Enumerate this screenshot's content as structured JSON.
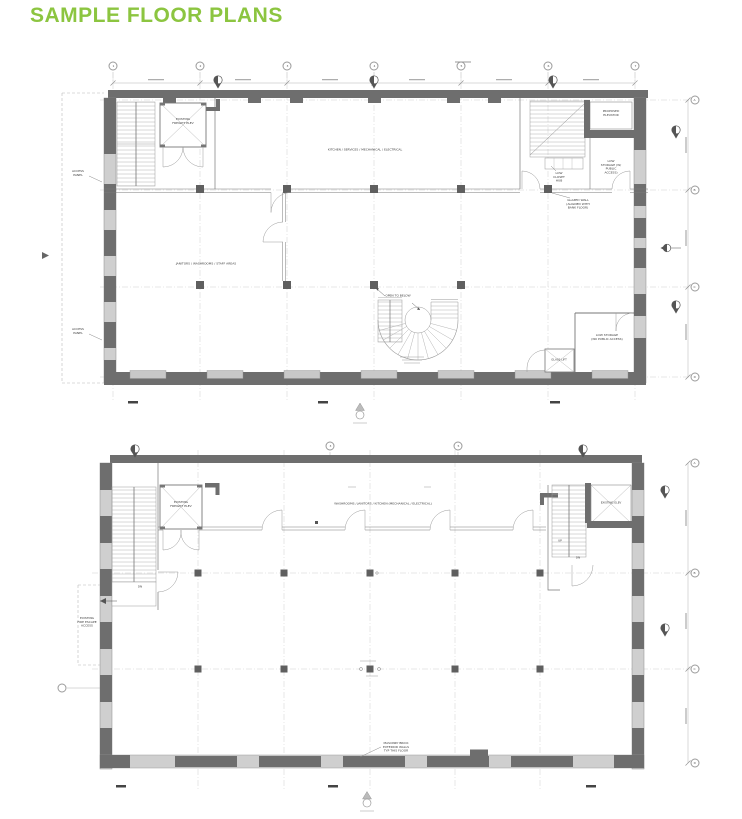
{
  "page": {
    "title": "SAMPLE FLOOR PLANS",
    "accent_green": "#8cc540",
    "wall_dark": "#6e6e6e",
    "wall_light": "#cfcfcf"
  },
  "plan_upper": {
    "grid_top": [
      "1",
      "2",
      "3",
      "4",
      "5",
      "6",
      "7"
    ],
    "grid_right": [
      "A",
      "B",
      "C",
      "D"
    ],
    "labels": {
      "freight_elev": "EXISTING\nFREIGHT ELEV",
      "kitchen": "KITCHEN / SERVICES / MECHANICAL / ELECTRICAL",
      "janitors": "JANITORS / WASHROOMS / STAFF AREAS",
      "open_to_below": "OPEN TO BELOW",
      "access_panel_1": "ACCESS\nPANEL",
      "access_panel_2": "ACCESS\nPANEL",
      "proposed_elev": "PROPOSED\nELEVATOR",
      "low_closet": "LOW\nCLOSET\nHUB",
      "low_storage_public": "LOW\nSTORAGE (W/\nPUBLIC\nACCESS)",
      "glazed_wall": "GLAZED WALL\n(ALIGNED WITH\nBANK FLOOR)",
      "low_storage_no_public": "LOW STORAGE\n(NO PUBLIC ACCESS)",
      "glass_lift": "GLASS LIFT"
    }
  },
  "plan_lower": {
    "grid_top": [
      "3",
      "5"
    ],
    "grid_right": [
      "A",
      "B",
      "C",
      "D"
    ],
    "labels": {
      "freight_elev": "EXISTING\nFREIGHT ELEV",
      "washrooms": "WASHROOMS / JANITORS / KITCHEN (MECHANICAL / ELECTRICAL)",
      "fire_escape": "EXISTING\nFIRE ESCAPE\nACCESS",
      "masonry": "MASONRY BRICK\nEXTERIOR WALLS\nTYP THIS FLOOR",
      "existing_elev": "EXISTING ELEV",
      "dn_left": "DN",
      "up_right": "UP",
      "dn_right": "DN"
    }
  }
}
